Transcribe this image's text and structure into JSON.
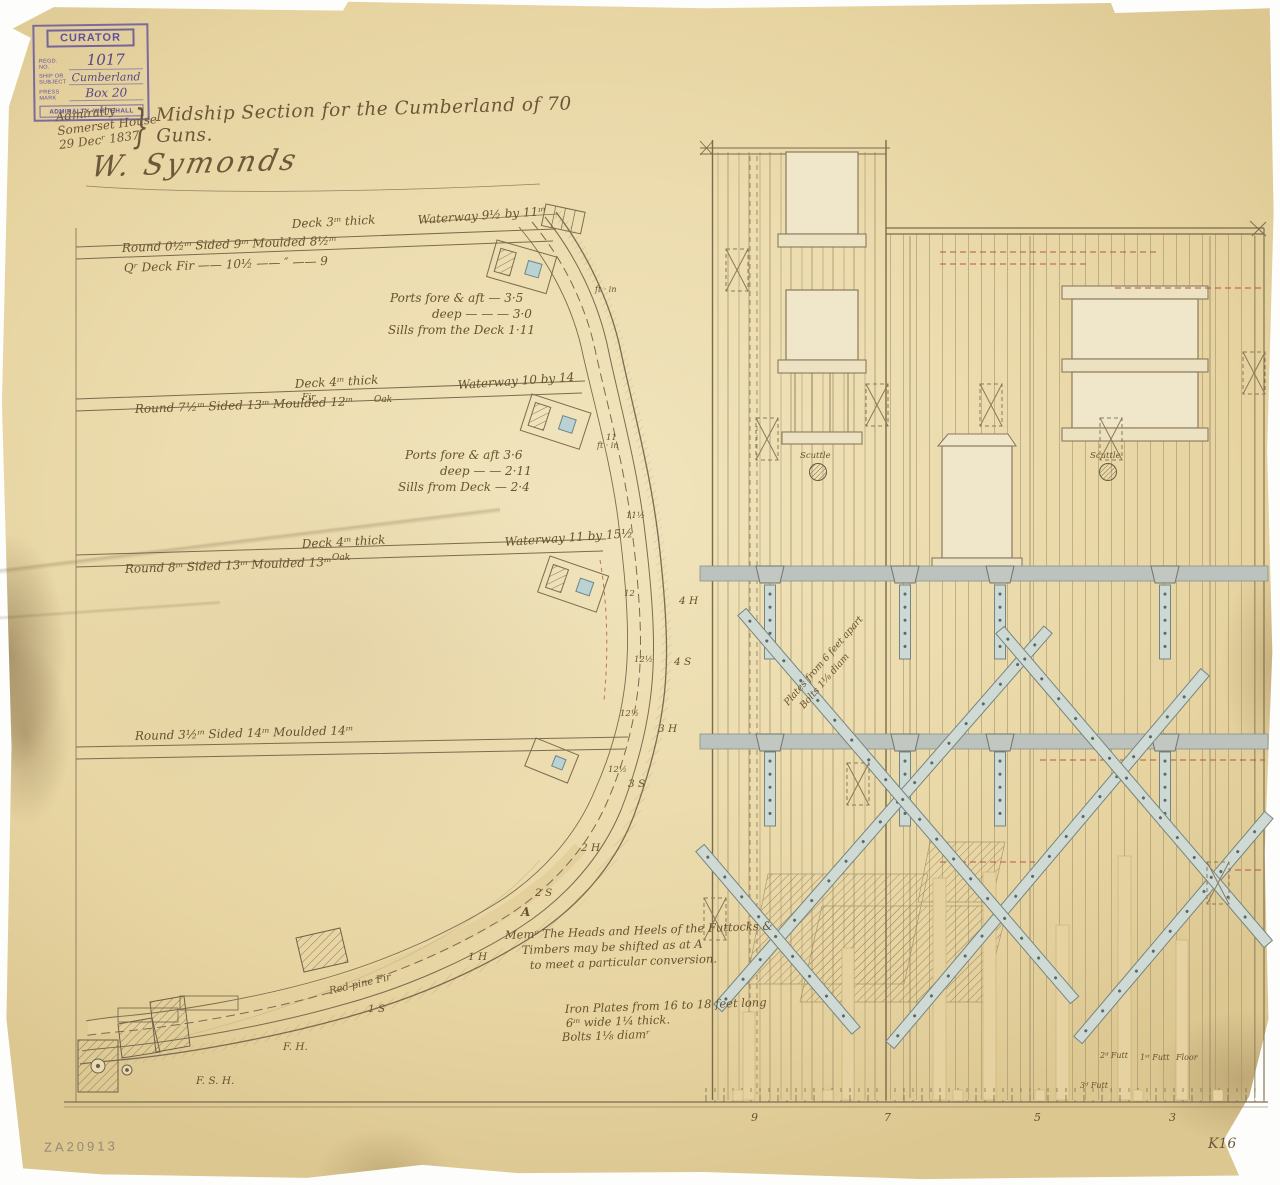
{
  "document": {
    "archive_number": "ZA20913",
    "sheet_ref": "K16"
  },
  "stamp": {
    "title": "CURATOR",
    "regd_label": "Regd. No.",
    "regd_value": "1017",
    "ship_label": "SHIP OR SUBJECT",
    "ship_value": "Cumberland",
    "press_label": "Press Mark",
    "press_value": "Box 20",
    "footer": "ADMIRALTY, WHITEHALL"
  },
  "header": {
    "office_line1": "Admiralty",
    "office_line2": "Somerset House",
    "office_line3": "29 Decʳ 1837",
    "brace": "}",
    "title": "Midship Section for the Cumberland of 70 Guns.",
    "signature": "W. Symonds"
  },
  "decks": {
    "deck1_thickness": "Deck 3ᶦⁿ thick",
    "deck1_waterway": "Waterway 9½ by 11ᶦⁿ",
    "deck1_beam": "Round 0½ᶦⁿ      Sided 9ᶦⁿ      Moulded 8½ᶦⁿ",
    "deck1_extra": "Qʳ Deck Fir ——  10½  —— ″ —— 9",
    "ports1_units": "ft · in",
    "ports1_l1": "Ports fore & aft — 3·5",
    "ports1_l2": "deep — — — 3·0",
    "ports1_l3": "Sills from the Deck 1·11",
    "deck2_thickness": "Deck 4ᶦⁿ thick",
    "deck2_mat1": "Fir",
    "deck2_mat2": "Oak",
    "deck2_waterway": "Waterway 10 by 14",
    "deck2_beam": "Round 7½ᶦⁿ      Sided 13ᶦⁿ      Moulded 12ᶦⁿ",
    "ports2_units": "ft · in",
    "ports2_l1": "Ports fore & aft    3·6",
    "ports2_l2": "deep — —  2·11",
    "ports2_l3": "Sills from Deck — 2·4",
    "deck3_thickness": "Deck 4ᶦⁿ thick",
    "deck3_mat": "Oak",
    "deck3_waterway": "Waterway 11 by 15½",
    "deck3_beam": "Round 8ᶦⁿ      Sided 13ᶦⁿ      Moulded 13ᶦⁿ",
    "deck4_beam": "Round 3½ᶦⁿ      Sided 14ᶦⁿ      Moulded 14ᶦⁿ"
  },
  "notes": {
    "memo_l1": "Memᵒ  The Heads and Heels of the Futtocks &",
    "memo_l2": "Timbers may be shifted as at A",
    "memo_l3": "to meet a particular conversion.",
    "iron_l1": "Iron Plates from 16 to 18 feet long",
    "iron_l2": "6ᶦⁿ wide  1¼ thick.",
    "iron_l3": "Bolts 1⅛ diamʳ",
    "rider_l1": "Plates from 6 feet apart",
    "rider_l2": "Bolts 1⅛ diam",
    "red_pine": "Red pine Fir"
  },
  "frames": {
    "f4h": "4 H",
    "f4s": "4 S",
    "f3h": "3 H",
    "f3s": "3 S",
    "f2h": "2 H",
    "f2s": "2 S",
    "f1h": "1 H",
    "f1s": "1 S",
    "fh": "F. H.",
    "fsh": "F. S. H.",
    "a": "A",
    "n11": "11",
    "n115": "11½",
    "n12": "12",
    "n125a": "12½",
    "n125b": "12½",
    "n125c": "12½"
  },
  "elevation": {
    "scuttle_left": "Scuttle",
    "scuttle_right": "Scuttle",
    "timber_2f": "2ᵈ Futt",
    "timber_1f": "1ˢᵗ Futt",
    "timber_floor": "Floor",
    "timber_3f": "3ᵈ Futt",
    "stations": [
      "9",
      "7",
      "5",
      "3"
    ]
  }
}
